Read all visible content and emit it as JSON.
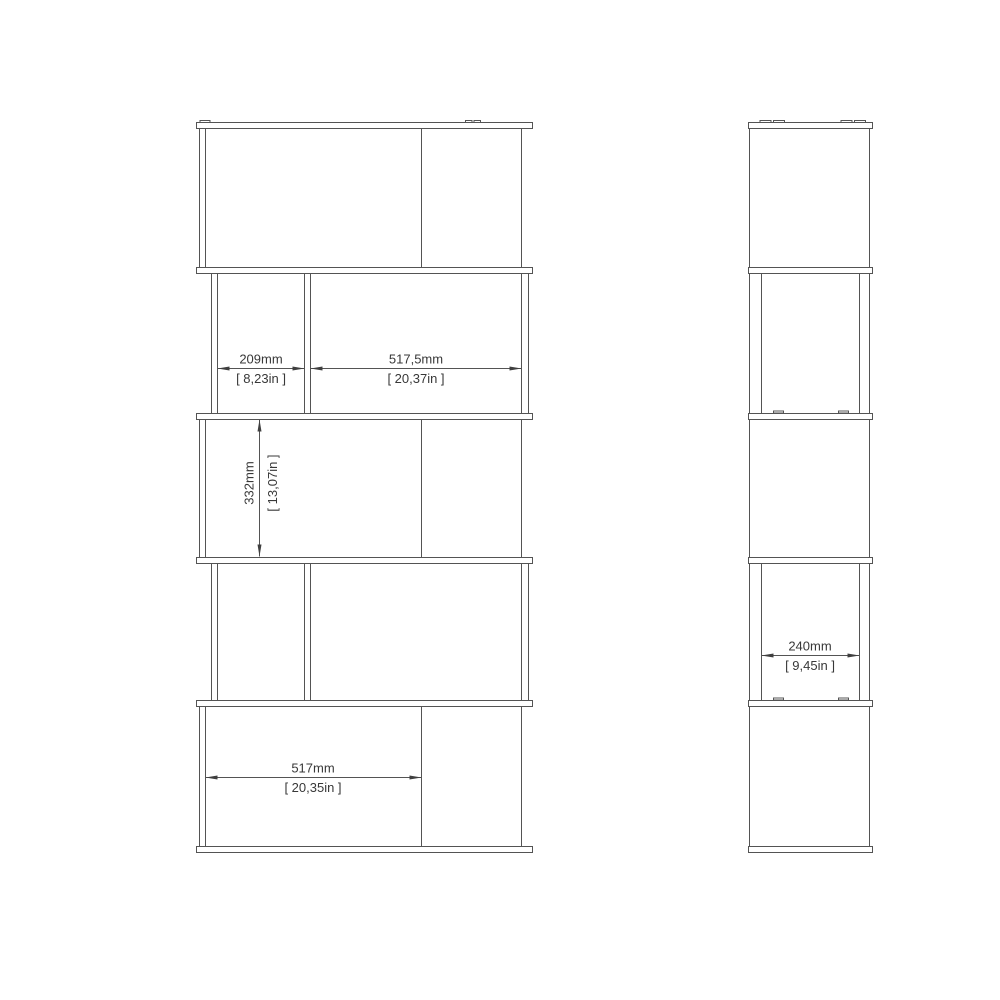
{
  "page": {
    "background_color": "#ffffff",
    "line_color": "#545454",
    "text_color": "#383838"
  },
  "drawing": {
    "front_view": {
      "dim_top_left_opening": {
        "mm": "209mm",
        "inches": "[ 8,23in ]"
      },
      "dim_top_right_opening": {
        "mm": "517,5mm",
        "inches": "[ 20,37in ]"
      },
      "dim_middle_height": {
        "mm": "332mm",
        "inches": "[ 13,07in ]"
      },
      "dim_bottom_opening": {
        "mm": "517mm",
        "inches": "[ 20,35in ]"
      }
    },
    "side_view": {
      "dim_depth": {
        "mm": "240mm",
        "inches": "[ 9,45in ]"
      }
    }
  }
}
